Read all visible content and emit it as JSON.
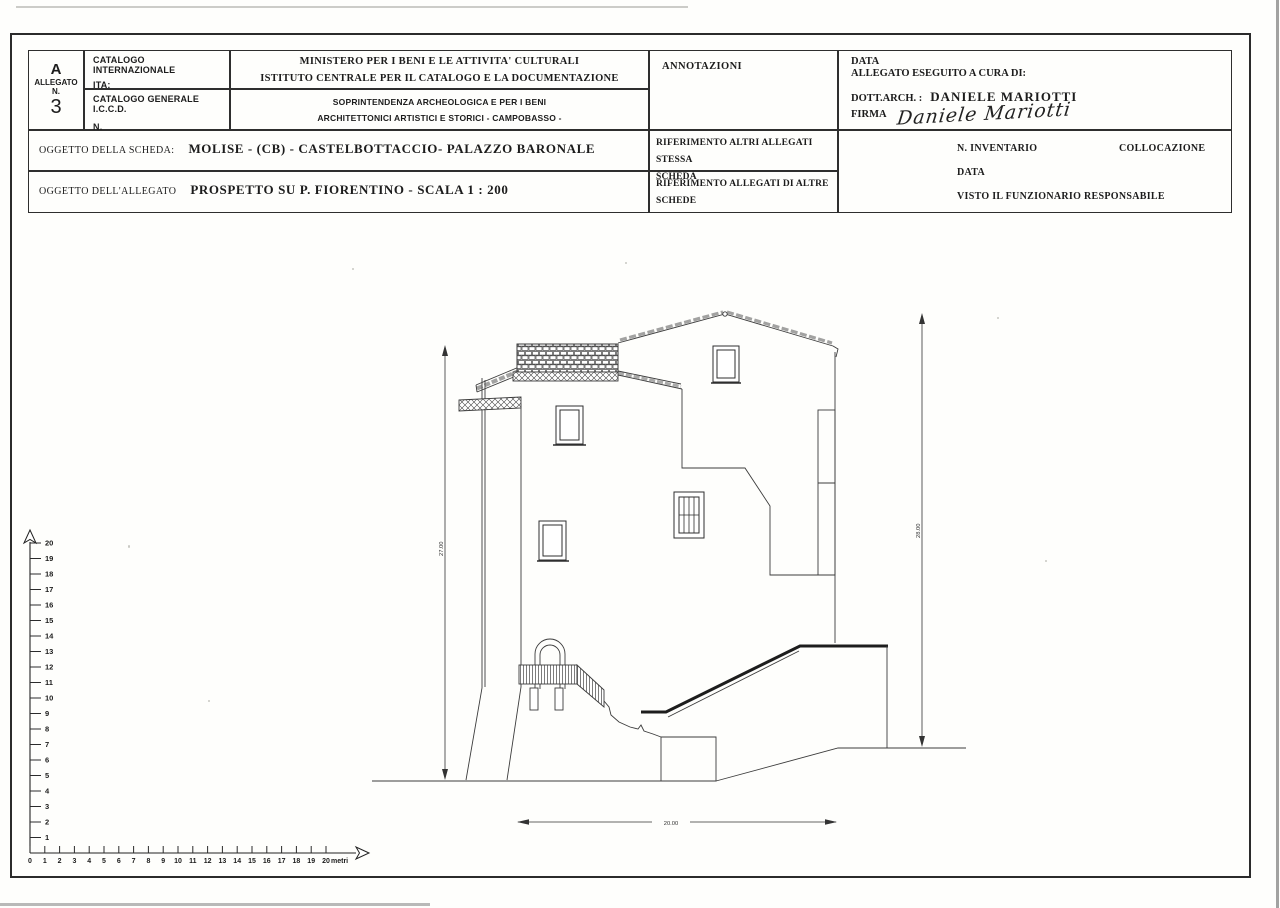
{
  "form": {
    "allegato": {
      "letter": "A",
      "label": "ALLEGATO",
      "n_label": "N.",
      "number": "3"
    },
    "catalogo": {
      "internazionale_label": "CATALOGO INTERNAZIONALE",
      "ita_label": "ITA:",
      "generale_label": "CATALOGO GENERALE",
      "iccd": "I.C.C.D.",
      "n_label": "N."
    },
    "ministero": {
      "line1": "MINISTERO PER I BENI E LE ATTIVITA' CULTURALI",
      "line2": "ISTITUTO CENTRALE PER IL CATALOGO E LA DOCUMENTAZIONE",
      "line3": "SOPRINTENDENZA ARCHEOLOGICA E PER I BENI",
      "line4": "ARCHITETTONICI ARTISTICI E STORICI - CAMPOBASSO -"
    },
    "annotazioni_label": "ANNOTAZIONI",
    "esecuzione": {
      "data_label": "DATA",
      "a_cura_label": "ALLEGATO ESEGUITO A CURA DI:",
      "arch_label": "DOTT.ARCH. :",
      "arch_name": "DANIELE MARIOTTI",
      "firma_label": "FIRMA",
      "signature": "Daniele Mariotti"
    },
    "oggetto_scheda": {
      "label": "OGGETTO DELLA SCHEDA:",
      "value": "MOLISE - (CB) - CASTELBOTTACCIO- PALAZZO BARONALE"
    },
    "oggetto_allegato": {
      "label": "OGGETTO DELL'ALLEGATO",
      "value": "PROSPETTO  SU P. FIORENTINO  - SCALA 1 : 200"
    },
    "riferimenti": {
      "stessa_line1": "RIFERIMENTO ALTRI ALLEGATI STESSA",
      "stessa_line2": "SCHEDA",
      "altre_line1": "RIFERIMENTO ALLEGATI DI ALTRE",
      "altre_line2": "SCHEDE"
    },
    "ufficio": {
      "inventario_label": "N. INVENTARIO",
      "collocazione_label": "COLLOCAZIONE",
      "data_label": "DATA",
      "visto_label": "VISTO IL FUNZIONARIO RESPONSABILE"
    }
  },
  "drawing": {
    "subject": "Prospetto su P. Fiorentino - Palazzo Baronale, Castelbottaccio (CB)",
    "scale": "1 : 200",
    "dimensions": {
      "left_height_m": "27.00",
      "right_height_m": "28.00",
      "bottom_width_m": "20.00"
    },
    "scale_ruler": {
      "vertical_labels": [
        "1",
        "2",
        "3",
        "4",
        "5",
        "6",
        "7",
        "8",
        "9",
        "10",
        "11",
        "12",
        "13",
        "14",
        "15",
        "16",
        "17",
        "18",
        "19",
        "20"
      ],
      "horizontal_labels": [
        "0",
        "1",
        "2",
        "3",
        "4",
        "5",
        "6",
        "7",
        "8",
        "9",
        "10",
        "11",
        "12",
        "13",
        "14",
        "15",
        "16",
        "17",
        "18",
        "19",
        "20"
      ],
      "unit": "metri"
    }
  },
  "colors": {
    "paper": "#fefefc",
    "ink": "#2b2b2b",
    "drawing_line": "#3c3c3c"
  }
}
